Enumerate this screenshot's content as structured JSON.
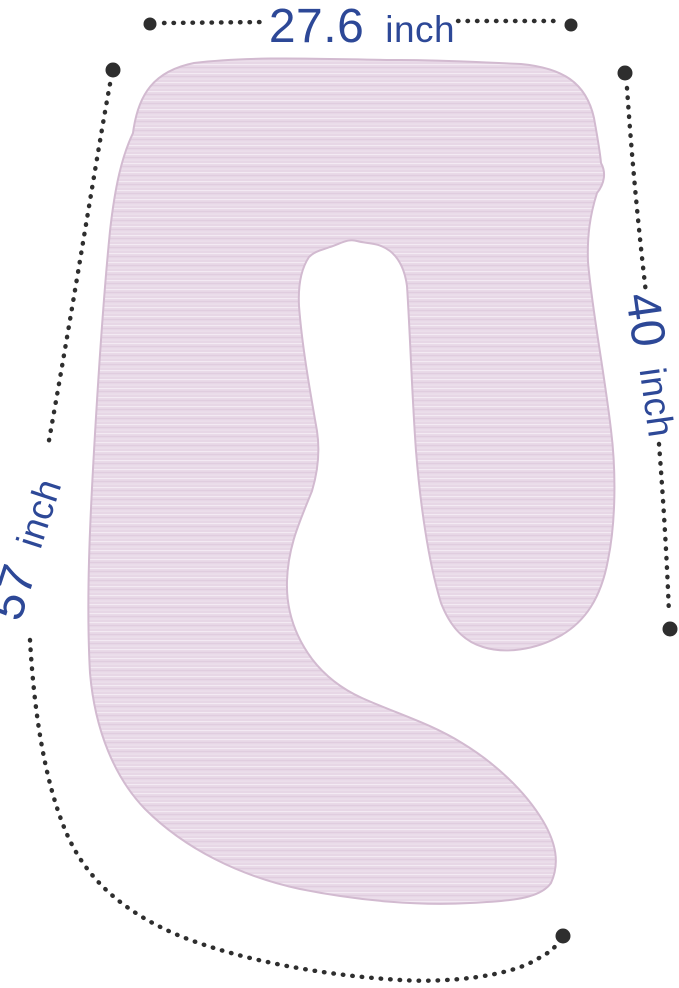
{
  "diagram": {
    "subject": "pregnancy-body-pillow",
    "background_color": "#ffffff",
    "colors": {
      "pillow_fill": "#e7d7e6",
      "pillow_fill_light": "#f3eaf3",
      "pillow_fill_dark": "#ddc9dc",
      "pillow_edge": "#d2bad0",
      "label": "#2d4897",
      "line": "#2e2e2e"
    },
    "measurements": {
      "top_width": {
        "value": "27.6",
        "unit": "inch"
      },
      "right_height": {
        "value": "40",
        "unit": "inch"
      },
      "left_length": {
        "value": "57",
        "unit": "inch"
      }
    }
  }
}
